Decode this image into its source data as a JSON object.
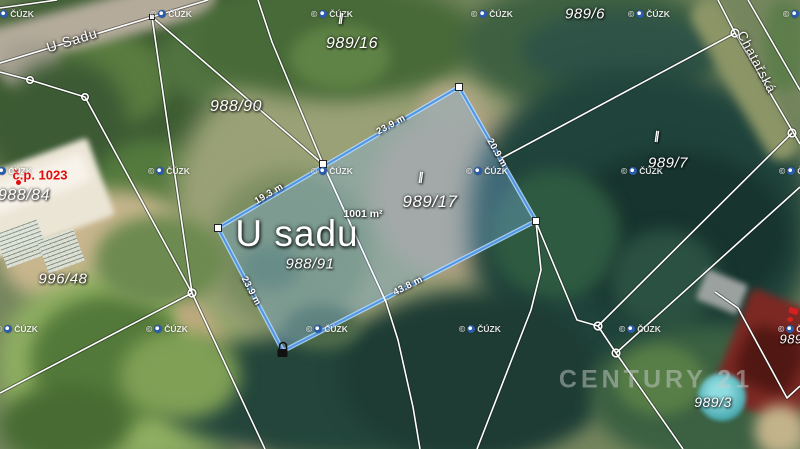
{
  "map": {
    "street_labels": [
      {
        "text": "U Sadu",
        "x": 72,
        "y": 40,
        "rot": -17,
        "size": 14
      },
      {
        "text": "Chatařská",
        "x": 757,
        "y": 62,
        "rot": 62,
        "size": 13
      }
    ],
    "parcel_labels": [
      {
        "text": "989/16",
        "x": 352,
        "y": 44,
        "size": 16
      },
      {
        "text": "988/90",
        "x": 236,
        "y": 107,
        "size": 16
      },
      {
        "text": "989/6",
        "x": 585,
        "y": 14,
        "size": 15
      },
      {
        "text": "989/7",
        "x": 668,
        "y": 163,
        "size": 15
      },
      {
        "text": "988/84",
        "x": 24,
        "y": 196,
        "size": 16
      },
      {
        "text": "996/48",
        "x": 63,
        "y": 279,
        "size": 15
      },
      {
        "text": "988/91",
        "x": 310,
        "y": 264,
        "size": 15
      },
      {
        "text": "989/17",
        "x": 430,
        "y": 202,
        "size": 17
      },
      {
        "text": "989/3",
        "x": 713,
        "y": 402,
        "size": 14
      },
      {
        "text": "989/1",
        "x": 797,
        "y": 339,
        "size": 13
      }
    ],
    "big_label": {
      "text": "U sadu",
      "x": 297,
      "y": 234
    },
    "area_label": {
      "text": "1001 m²",
      "x": 363,
      "y": 214
    },
    "building_label": {
      "text": "č.p. 1023",
      "x": 40,
      "y": 175,
      "color": "#e30b0b"
    },
    "highlight": {
      "stroke_color": "#4e96e6",
      "glow_color": "rgba(185,220,255,0.85)",
      "fill_color": "rgba(130,185,245,0.32)",
      "dimensions": [
        {
          "text": "23.9 m",
          "x": 391,
          "y": 125,
          "rot": -29
        },
        {
          "text": "19.3 m",
          "x": 269,
          "y": 194,
          "rot": -31
        },
        {
          "text": "43.8 m",
          "x": 408,
          "y": 286,
          "rot": -27
        },
        {
          "text": "20.9 m",
          "x": 497,
          "y": 153,
          "rot": 60
        },
        {
          "text": "23.9 m",
          "x": 251,
          "y": 291,
          "rot": 62
        }
      ]
    },
    "tick_symbol": "∥",
    "ticks": [
      {
        "x": 341,
        "y": 18
      },
      {
        "x": 421,
        "y": 177
      },
      {
        "x": 657,
        "y": 136
      }
    ],
    "watermark": {
      "text": "© ČÚZK",
      "positions": [
        {
          "x": -8,
          "y": 9
        },
        {
          "x": 150,
          "y": 9
        },
        {
          "x": 311,
          "y": 9
        },
        {
          "x": 471,
          "y": 9
        },
        {
          "x": 628,
          "y": 9
        },
        {
          "x": 783,
          "y": 9
        },
        {
          "x": -10,
          "y": 166
        },
        {
          "x": 148,
          "y": 166
        },
        {
          "x": 311,
          "y": 166
        },
        {
          "x": 466,
          "y": 166
        },
        {
          "x": 621,
          "y": 166
        },
        {
          "x": 779,
          "y": 166
        },
        {
          "x": -4,
          "y": 324
        },
        {
          "x": 146,
          "y": 324
        },
        {
          "x": 306,
          "y": 324
        },
        {
          "x": 459,
          "y": 324
        },
        {
          "x": 619,
          "y": 324
        },
        {
          "x": 778,
          "y": 324
        }
      ]
    },
    "brand_watermark": {
      "text": "CENTURY 21",
      "x": 656,
      "y": 380
    }
  }
}
